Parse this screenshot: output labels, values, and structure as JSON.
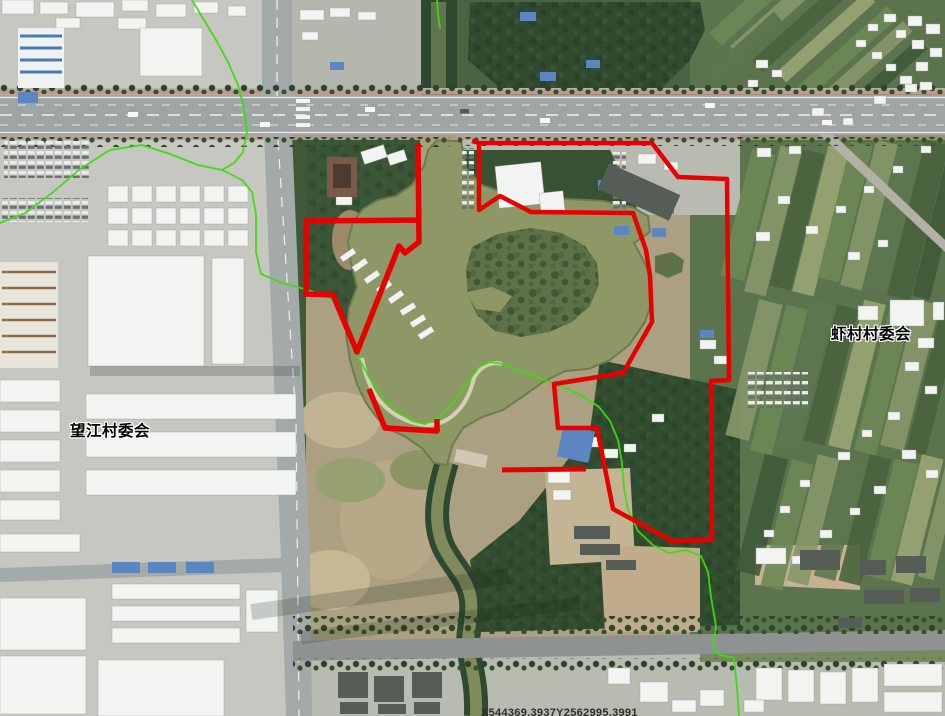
{
  "labels": {
    "wangjiang": {
      "text": "望江村委会"
    },
    "xiacun": {
      "text": "虾村村委会"
    }
  },
  "watermark": {
    "text": "X544369.3937Y2562995.3991"
  },
  "palette": {
    "boundary_red": "#e60000",
    "boundary_green": "#3cdc0e",
    "label_text": "#000000",
    "label_halo": "#ffffff",
    "watermark_text": "#2e2e2e",
    "pond_water": "#8e9766",
    "farmland": "#5c744d",
    "road": "#9fa5a5"
  },
  "boundaries": {
    "red": {
      "right_parcel": "472,141 479,143 652,143 678,177 727,179 729,380 711,381 712,540 672,541 613,509 597,428 558,428 554,384 623,373 631,359 652,322 650,276 646,250 633,213 531,212 500,196 479,210 479,143",
      "left_parcel": "418,143 419,242 405,253 399,246 357,352 333,295 306,294 306,221 421,220",
      "south_segment": "369,389 385,428 437,431 437,419",
      "detached_segment": "502,470 586,469"
    },
    "green": {
      "segments": [
        {
          "points": "192,0 204,20 216,40 228,62 238,85 244,108 247,132 243,152 234,163 222,170"
        },
        {
          "points": "0,223 25,213 52,193 80,169 110,150 142,145 170,154 198,165 222,170"
        },
        {
          "points": "222,170 242,180 252,192 256,214 256,252 261,274 280,282 311,291 332,299 345,325 357,355 370,379 383,398 397,411 412,421 425,424 440,417 456,400 468,382 479,367 490,362 503,364 520,371 537,377 553,383 570,390 586,398 599,407 610,421 618,440 622,463 624,488 628,510 638,531 653,545 669,553 686,550 701,556 708,572 711,597 716,626 713,648 720,655 734,658 737,688 739,716"
        },
        {
          "points": "437,0 438,14 440,28"
        }
      ]
    }
  },
  "imagery": {
    "white_buildings": [
      [
        2,
        0,
        32,
        14
      ],
      [
        40,
        2,
        28,
        12
      ],
      [
        76,
        2,
        38,
        15
      ],
      [
        122,
        0,
        26,
        11
      ],
      [
        156,
        4,
        30,
        13
      ],
      [
        194,
        2,
        24,
        11
      ],
      [
        118,
        18,
        28,
        11
      ],
      [
        56,
        18,
        24,
        10
      ],
      [
        228,
        6,
        18,
        10
      ],
      [
        140,
        28,
        62,
        48
      ],
      [
        108,
        186,
        20,
        16
      ],
      [
        132,
        186,
        20,
        16
      ],
      [
        156,
        186,
        20,
        16
      ],
      [
        180,
        186,
        20,
        16
      ],
      [
        204,
        186,
        20,
        16
      ],
      [
        228,
        186,
        20,
        16
      ],
      [
        108,
        208,
        20,
        16
      ],
      [
        132,
        208,
        20,
        16
      ],
      [
        156,
        208,
        20,
        16
      ],
      [
        180,
        208,
        20,
        16
      ],
      [
        204,
        208,
        20,
        16
      ],
      [
        228,
        208,
        20,
        16
      ],
      [
        108,
        230,
        20,
        16
      ],
      [
        132,
        230,
        20,
        16
      ],
      [
        156,
        230,
        20,
        16
      ],
      [
        180,
        230,
        20,
        16
      ],
      [
        204,
        230,
        20,
        16
      ],
      [
        228,
        230,
        20,
        16
      ],
      [
        88,
        256,
        116,
        110
      ],
      [
        212,
        258,
        32,
        106
      ],
      [
        86,
        394,
        210,
        25
      ],
      [
        86,
        432,
        210,
        25
      ],
      [
        86,
        470,
        210,
        25
      ],
      [
        0,
        380,
        60,
        22
      ],
      [
        0,
        410,
        60,
        22
      ],
      [
        0,
        440,
        60,
        22
      ],
      [
        0,
        470,
        60,
        22
      ],
      [
        0,
        500,
        60,
        20
      ],
      [
        0,
        534,
        80,
        18
      ],
      [
        112,
        584,
        128,
        15
      ],
      [
        112,
        606,
        128,
        15
      ],
      [
        112,
        628,
        128,
        15
      ],
      [
        246,
        590,
        32,
        42
      ],
      [
        0,
        598,
        86,
        52
      ],
      [
        0,
        656,
        86,
        58
      ],
      [
        98,
        660,
        126,
        56
      ],
      [
        300,
        10,
        24,
        10
      ],
      [
        330,
        8,
        20,
        9
      ],
      [
        358,
        12,
        18,
        8
      ],
      [
        302,
        32,
        16,
        8
      ],
      [
        497,
        164,
        46,
        42,
        -6
      ],
      [
        540,
        192,
        24,
        20,
        -6
      ],
      [
        638,
        154,
        18,
        10
      ],
      [
        664,
        162,
        14,
        8
      ],
      [
        336,
        196,
        16,
        9
      ],
      [
        362,
        148,
        24,
        13,
        -18
      ],
      [
        388,
        152,
        18,
        11,
        -18
      ],
      [
        340,
        252,
        16,
        6,
        -35
      ],
      [
        352,
        262,
        16,
        6,
        -35
      ],
      [
        364,
        274,
        16,
        6,
        -35
      ],
      [
        376,
        284,
        16,
        6,
        -35
      ],
      [
        388,
        294,
        16,
        6,
        -35
      ],
      [
        400,
        306,
        16,
        6,
        -32
      ],
      [
        410,
        318,
        16,
        6,
        -32
      ],
      [
        418,
        330,
        16,
        6,
        -32
      ],
      [
        584,
        437,
        16,
        10
      ],
      [
        604,
        449,
        14,
        9
      ],
      [
        624,
        444,
        12,
        8
      ],
      [
        652,
        414,
        12,
        8
      ],
      [
        700,
        340,
        16,
        9
      ],
      [
        714,
        356,
        13,
        8
      ],
      [
        757,
        148,
        14,
        9
      ],
      [
        789,
        146,
        12,
        8
      ],
      [
        812,
        108,
        12,
        8
      ],
      [
        843,
        118,
        10,
        7
      ],
      [
        874,
        96,
        12,
        8
      ],
      [
        905,
        84,
        12,
        8
      ],
      [
        778,
        196,
        12,
        8
      ],
      [
        806,
        226,
        12,
        8
      ],
      [
        756,
        232,
        14,
        9
      ],
      [
        836,
        206,
        10,
        7
      ],
      [
        864,
        186,
        10,
        7
      ],
      [
        893,
        166,
        10,
        7
      ],
      [
        921,
        146,
        10,
        7
      ],
      [
        848,
        252,
        12,
        8
      ],
      [
        878,
        240,
        10,
        7
      ],
      [
        890,
        300,
        34,
        26
      ],
      [
        858,
        306,
        20,
        14
      ],
      [
        918,
        338,
        16,
        10
      ],
      [
        905,
        362,
        14,
        9
      ],
      [
        933,
        302,
        11,
        18
      ],
      [
        925,
        386,
        12,
        8
      ],
      [
        888,
        412,
        12,
        8
      ],
      [
        862,
        430,
        10,
        7
      ],
      [
        838,
        452,
        12,
        8
      ],
      [
        902,
        450,
        14,
        9
      ],
      [
        926,
        470,
        12,
        8
      ],
      [
        874,
        486,
        12,
        8
      ],
      [
        850,
        508,
        10,
        7
      ],
      [
        820,
        530,
        12,
        8
      ],
      [
        800,
        480,
        10,
        7
      ],
      [
        780,
        506,
        10,
        7
      ],
      [
        764,
        530,
        10,
        7
      ],
      [
        792,
        556,
        12,
        8
      ],
      [
        908,
        16,
        14,
        10
      ],
      [
        926,
        24,
        14,
        10
      ],
      [
        912,
        40,
        12,
        9
      ],
      [
        930,
        48,
        12,
        9
      ],
      [
        916,
        62,
        12,
        9
      ],
      [
        896,
        30,
        10,
        8
      ],
      [
        884,
        14,
        12,
        8
      ],
      [
        868,
        24,
        10,
        7
      ],
      [
        856,
        40,
        10,
        7
      ],
      [
        872,
        52,
        10,
        7
      ],
      [
        886,
        64,
        10,
        7
      ],
      [
        900,
        76,
        12,
        8
      ],
      [
        920,
        82,
        12,
        8
      ],
      [
        756,
        60,
        12,
        8
      ],
      [
        772,
        70,
        10,
        7
      ],
      [
        748,
        80,
        10,
        7
      ],
      [
        756,
        668,
        26,
        32
      ],
      [
        788,
        670,
        26,
        32
      ],
      [
        820,
        672,
        26,
        32
      ],
      [
        852,
        668,
        26,
        34
      ],
      [
        884,
        664,
        58,
        22
      ],
      [
        884,
        692,
        58,
        20
      ],
      [
        744,
        700,
        20,
        12
      ],
      [
        700,
        690,
        24,
        16
      ],
      [
        756,
        548,
        30,
        16
      ],
      [
        548,
        470,
        22,
        13
      ],
      [
        553,
        490,
        18,
        10
      ],
      [
        608,
        668,
        22,
        16
      ],
      [
        640,
        682,
        28,
        20
      ],
      [
        672,
        700,
        24,
        12
      ]
    ],
    "blue_buildings": [
      [
        18,
        92,
        20,
        11
      ],
      [
        112,
        562,
        28,
        11
      ],
      [
        148,
        562,
        28,
        11
      ],
      [
        186,
        562,
        28,
        11
      ],
      [
        330,
        62,
        14,
        8
      ],
      [
        520,
        12,
        16,
        9
      ],
      [
        540,
        72,
        16,
        9
      ],
      [
        586,
        60,
        14,
        8
      ],
      [
        598,
        180,
        16,
        10
      ],
      [
        614,
        226,
        15,
        9
      ],
      [
        652,
        228,
        14,
        9
      ],
      [
        662,
        206,
        12,
        8
      ],
      [
        700,
        330,
        14,
        8
      ],
      [
        560,
        428,
        32,
        32,
        12
      ]
    ],
    "gray_buildings": [
      [
        338,
        672,
        30,
        26
      ],
      [
        374,
        676,
        30,
        26
      ],
      [
        412,
        672,
        30,
        26
      ],
      [
        340,
        702,
        28,
        12
      ],
      [
        378,
        704,
        28,
        10
      ],
      [
        414,
        702,
        26,
        12
      ],
      [
        800,
        550,
        40,
        20
      ],
      [
        860,
        560,
        26,
        15
      ],
      [
        896,
        556,
        30,
        17
      ],
      [
        574,
        526,
        36,
        13
      ],
      [
        580,
        544,
        40,
        11
      ],
      [
        606,
        560,
        30,
        10
      ],
      [
        864,
        590,
        40,
        14
      ],
      [
        910,
        588,
        30,
        14
      ],
      [
        838,
        618,
        24,
        10
      ],
      [
        600,
        178,
        78,
        28,
        24
      ]
    ],
    "field_colors": [
      "#6d8955",
      "#4a633e",
      "#87986a",
      "#405a39",
      "#9aa573",
      "#5d7850"
    ],
    "field_strips": [
      [
        700,
        -10,
        120,
        18,
        -42,
        0
      ],
      [
        720,
        4,
        120,
        16,
        -42,
        2
      ],
      [
        742,
        18,
        120,
        16,
        -42,
        1
      ],
      [
        766,
        30,
        120,
        14,
        -42,
        4
      ],
      [
        788,
        44,
        120,
        16,
        -42,
        0
      ],
      [
        812,
        56,
        110,
        14,
        -42,
        2
      ],
      [
        836,
        70,
        100,
        14,
        -42,
        3
      ],
      [
        700,
        40,
        90,
        14,
        -42,
        5
      ],
      [
        736,
        150,
        24,
        130,
        14,
        0
      ],
      [
        762,
        146,
        22,
        150,
        14,
        2
      ],
      [
        786,
        150,
        22,
        140,
        14,
        1
      ],
      [
        810,
        146,
        22,
        150,
        14,
        4
      ],
      [
        834,
        142,
        22,
        140,
        14,
        0
      ],
      [
        858,
        140,
        22,
        150,
        14,
        2
      ],
      [
        882,
        140,
        22,
        150,
        14,
        5
      ],
      [
        906,
        140,
        24,
        160,
        14,
        1
      ],
      [
        930,
        150,
        18,
        150,
        14,
        3
      ],
      [
        742,
        300,
        24,
        140,
        14,
        2
      ],
      [
        768,
        305,
        22,
        150,
        14,
        0
      ],
      [
        794,
        300,
        22,
        150,
        14,
        5
      ],
      [
        820,
        305,
        22,
        140,
        14,
        1
      ],
      [
        846,
        300,
        22,
        150,
        14,
        4
      ],
      [
        872,
        305,
        22,
        150,
        14,
        0
      ],
      [
        898,
        300,
        24,
        150,
        14,
        2
      ],
      [
        924,
        305,
        20,
        150,
        14,
        1
      ],
      [
        750,
        455,
        24,
        120,
        14,
        3
      ],
      [
        776,
        460,
        22,
        130,
        14,
        0
      ],
      [
        802,
        455,
        22,
        130,
        14,
        2
      ],
      [
        828,
        460,
        22,
        120,
        14,
        5
      ],
      [
        854,
        455,
        22,
        130,
        14,
        1
      ],
      [
        880,
        460,
        24,
        120,
        14,
        0
      ],
      [
        906,
        455,
        22,
        130,
        14,
        4
      ],
      [
        932,
        460,
        16,
        120,
        14,
        2
      ]
    ]
  }
}
